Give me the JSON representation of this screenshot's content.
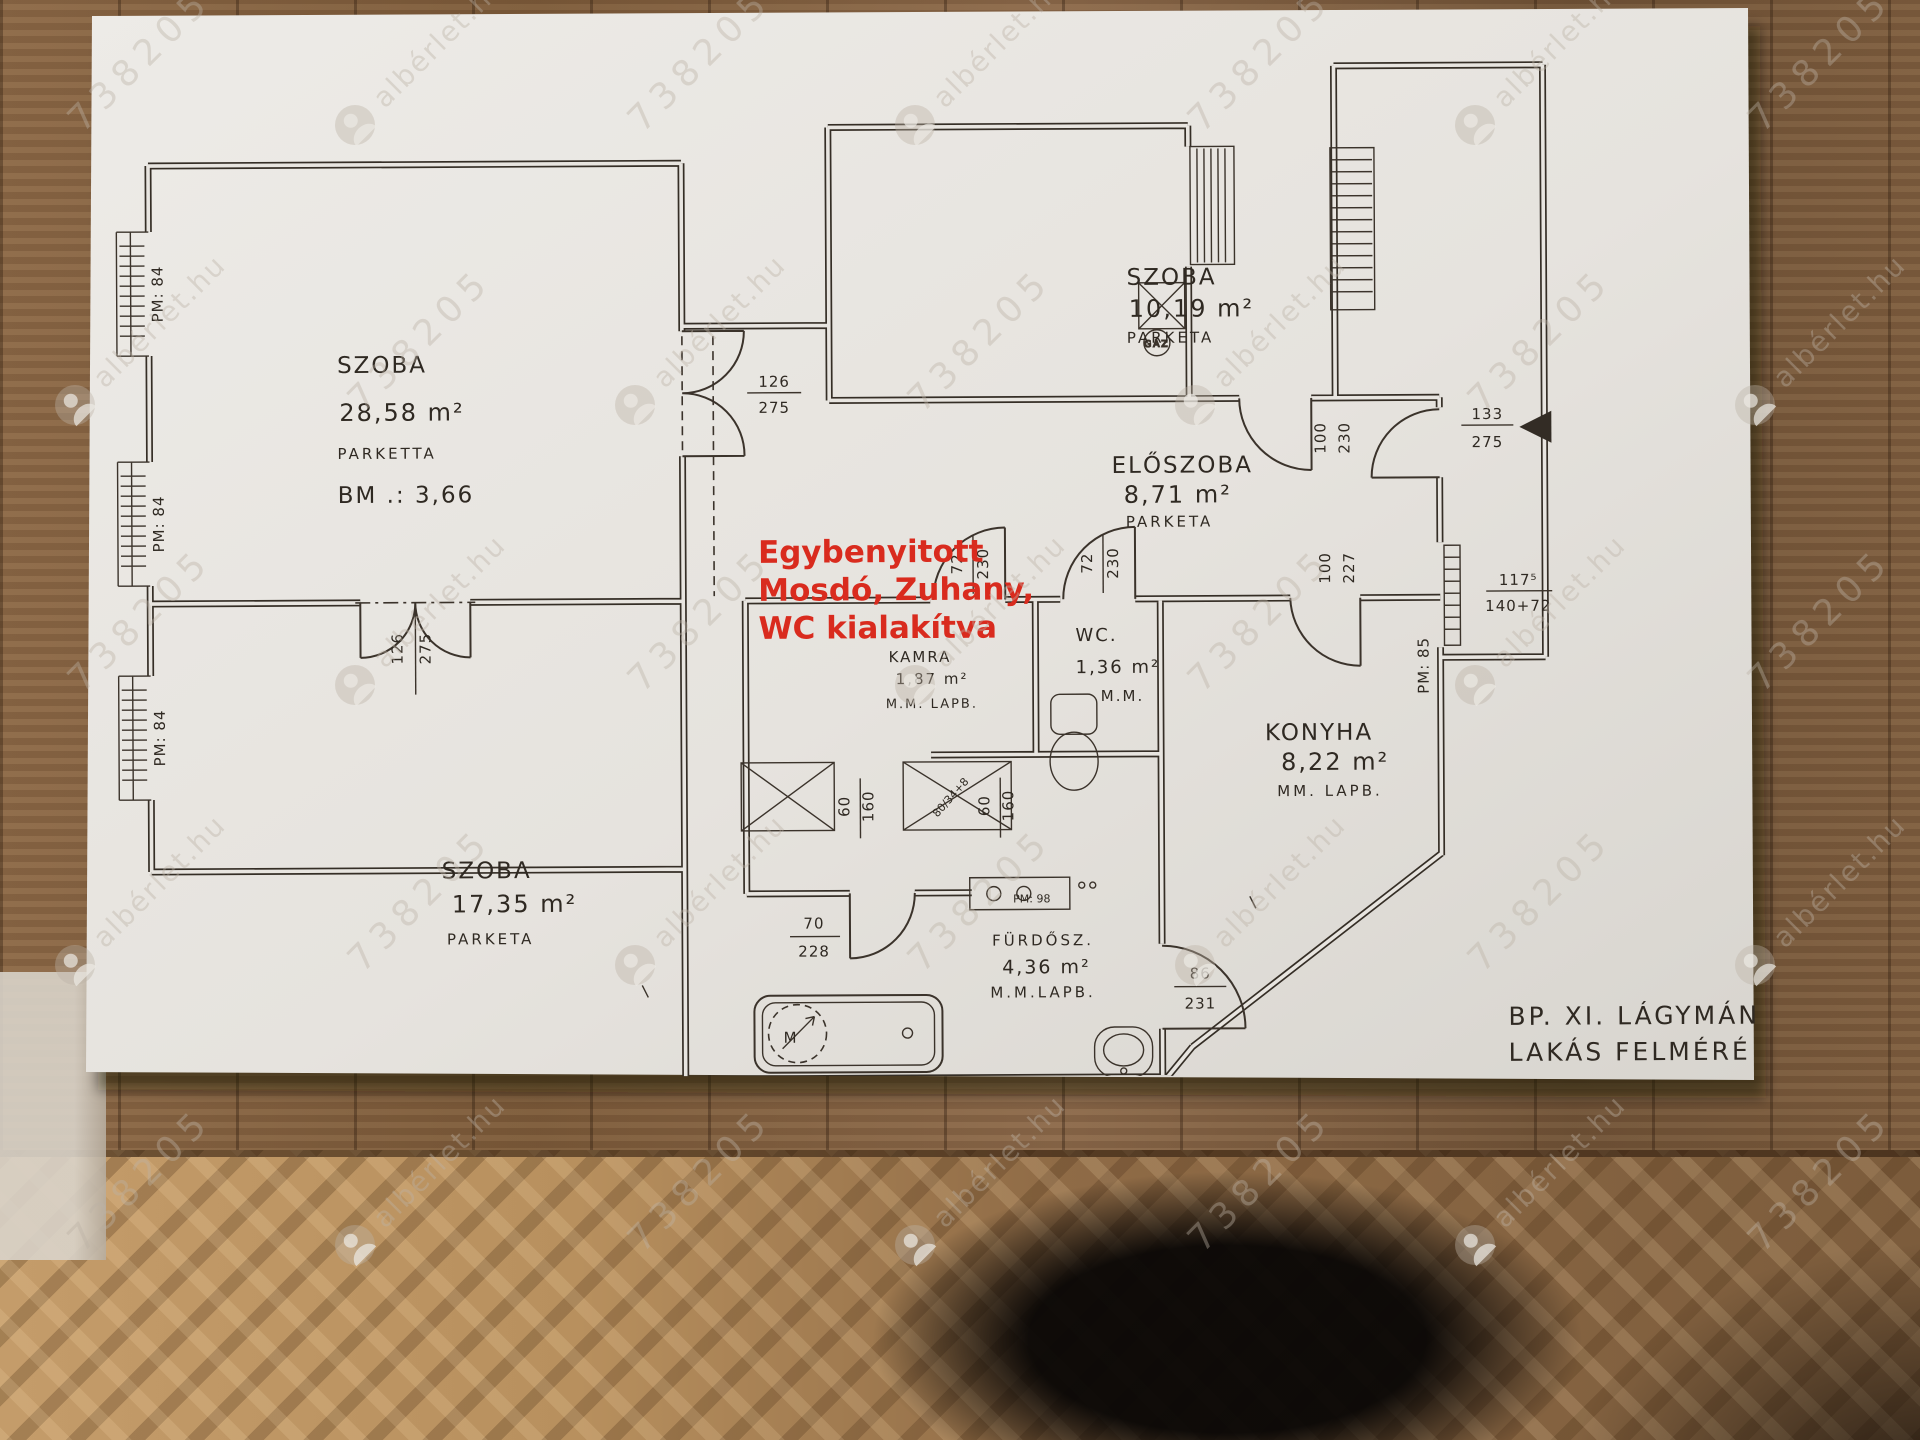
{
  "watermark": {
    "site": "albérlet.hu",
    "id": "738205"
  },
  "plan": {
    "rooms": {
      "szoba1": {
        "name": "SZOBA",
        "area": "28,58 m²",
        "floor": "PARKETTA",
        "height": "BM .: 3,66"
      },
      "szoba2": {
        "name": "SZOBA",
        "area": "10,19 m²",
        "floor": "PARKETA"
      },
      "eloszoba": {
        "name": "ELŐSZOBA",
        "area": "8,71 m²",
        "floor": "PARKETA"
      },
      "szoba3": {
        "name": "SZOBA",
        "area": "17,35 m²",
        "floor": "PARKETA"
      },
      "konyha": {
        "name": "KONYHA",
        "area": "8,22 m²",
        "floor": "MM. LAPB."
      },
      "furdo": {
        "name": "FÜRDŐSZ.",
        "area": "4,36 m²",
        "floor": "M.M.LAPB."
      },
      "wc": {
        "name": "WC.",
        "area": "1,36 m²",
        "floor": "M.M."
      },
      "kamra": {
        "name": "KAMRA",
        "area": "1,87 m²",
        "floor": "M.M. LAPB."
      }
    },
    "annotation": {
      "line1": "Egybenyitott",
      "line2": "Mosdó, Zuhany,",
      "line3": "WC kialakítva"
    },
    "dims": {
      "door_hall": {
        "w": "126",
        "h": "275"
      },
      "door_rooms": {
        "w": "126",
        "h": "275"
      },
      "door_small_1": {
        "w": "72",
        "h": "230"
      },
      "door_small_2": {
        "w": "72",
        "h": "230"
      },
      "door_szoba2": {
        "w": "100",
        "h": "230"
      },
      "door_konyha": {
        "w": "100",
        "h": "227"
      },
      "door_entry": {
        "w": "133",
        "h": "275"
      },
      "door_furdo": {
        "w": "70",
        "h": "228"
      },
      "door_back": {
        "w": "86",
        "h": "231"
      },
      "window_right": {
        "w": "117⁵",
        "h": "140+72"
      },
      "pm84": "PM: 84",
      "pm85": "PM: 85",
      "pm98": "PM: 98",
      "shower": {
        "w": "60",
        "h": "160"
      },
      "shower_diag": "80/34+8",
      "gaz": "GÁZ",
      "washer": "M"
    },
    "title_block": {
      "line1": "BP. XI.  LÁGYMÁN",
      "line2": "LAKÁS  FELMÉRÉ",
      "line3": "M = 1:50",
      "line4": "/1M=2.0CM/"
    }
  }
}
